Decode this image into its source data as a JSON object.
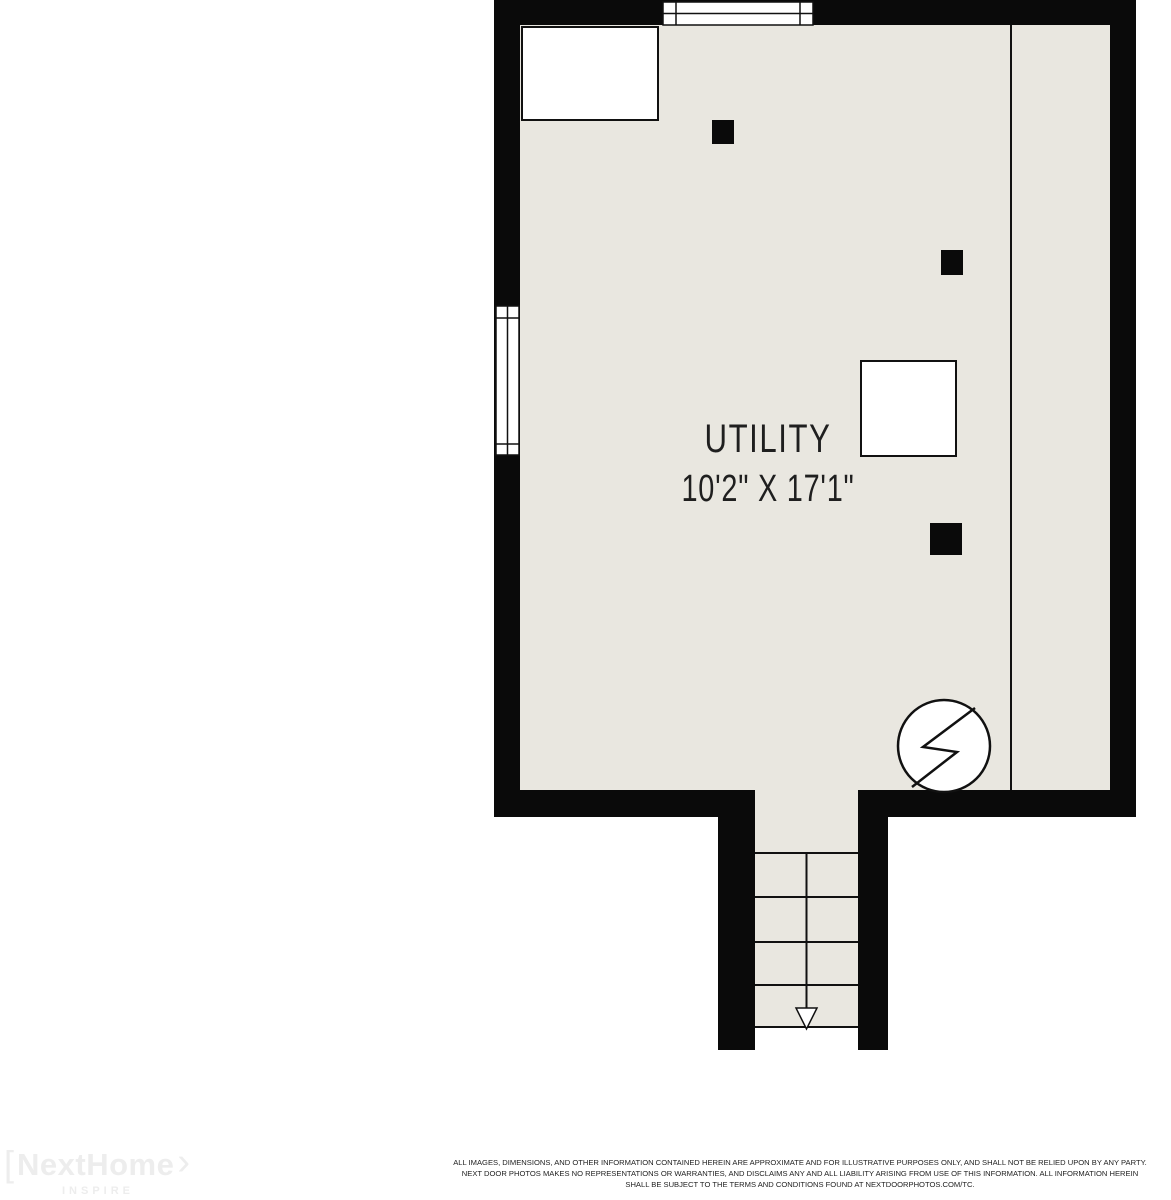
{
  "colors": {
    "wall": "#0a0a0a",
    "floor": "#e9e7e0",
    "line": "#111111",
    "label": "#1f1f1f",
    "logo": "#ededed",
    "disclaimer": "#222222"
  },
  "room": {
    "name": "UTILITY",
    "dimensions": "10'2\" X 17'1\""
  },
  "logo": {
    "bracket": "[",
    "brand": "NextHome",
    "chevron": "›",
    "tagline": "INSPIRE"
  },
  "disclaimer": {
    "line1": "ALL IMAGES, DIMENSIONS, AND OTHER INFORMATION CONTAINED HEREIN ARE APPROXIMATE AND FOR ILLUSTRATIVE PURPOSES ONLY, AND SHALL NOT BE RELIED UPON BY ANY PARTY.",
    "line2": "NEXT DOOR PHOTOS MAKES NO REPRESENTATIONS OR WARRANTIES, AND DISCLAIMS ANY AND ALL LIABILITY ARISING FROM USE OF THIS INFORMATION. ALL INFORMATION HEREIN",
    "line3": "SHALL BE SUBJECT TO THE TERMS AND CONDITIONS FOUND AT NEXTDOORPHOTOS.COM/TC."
  }
}
